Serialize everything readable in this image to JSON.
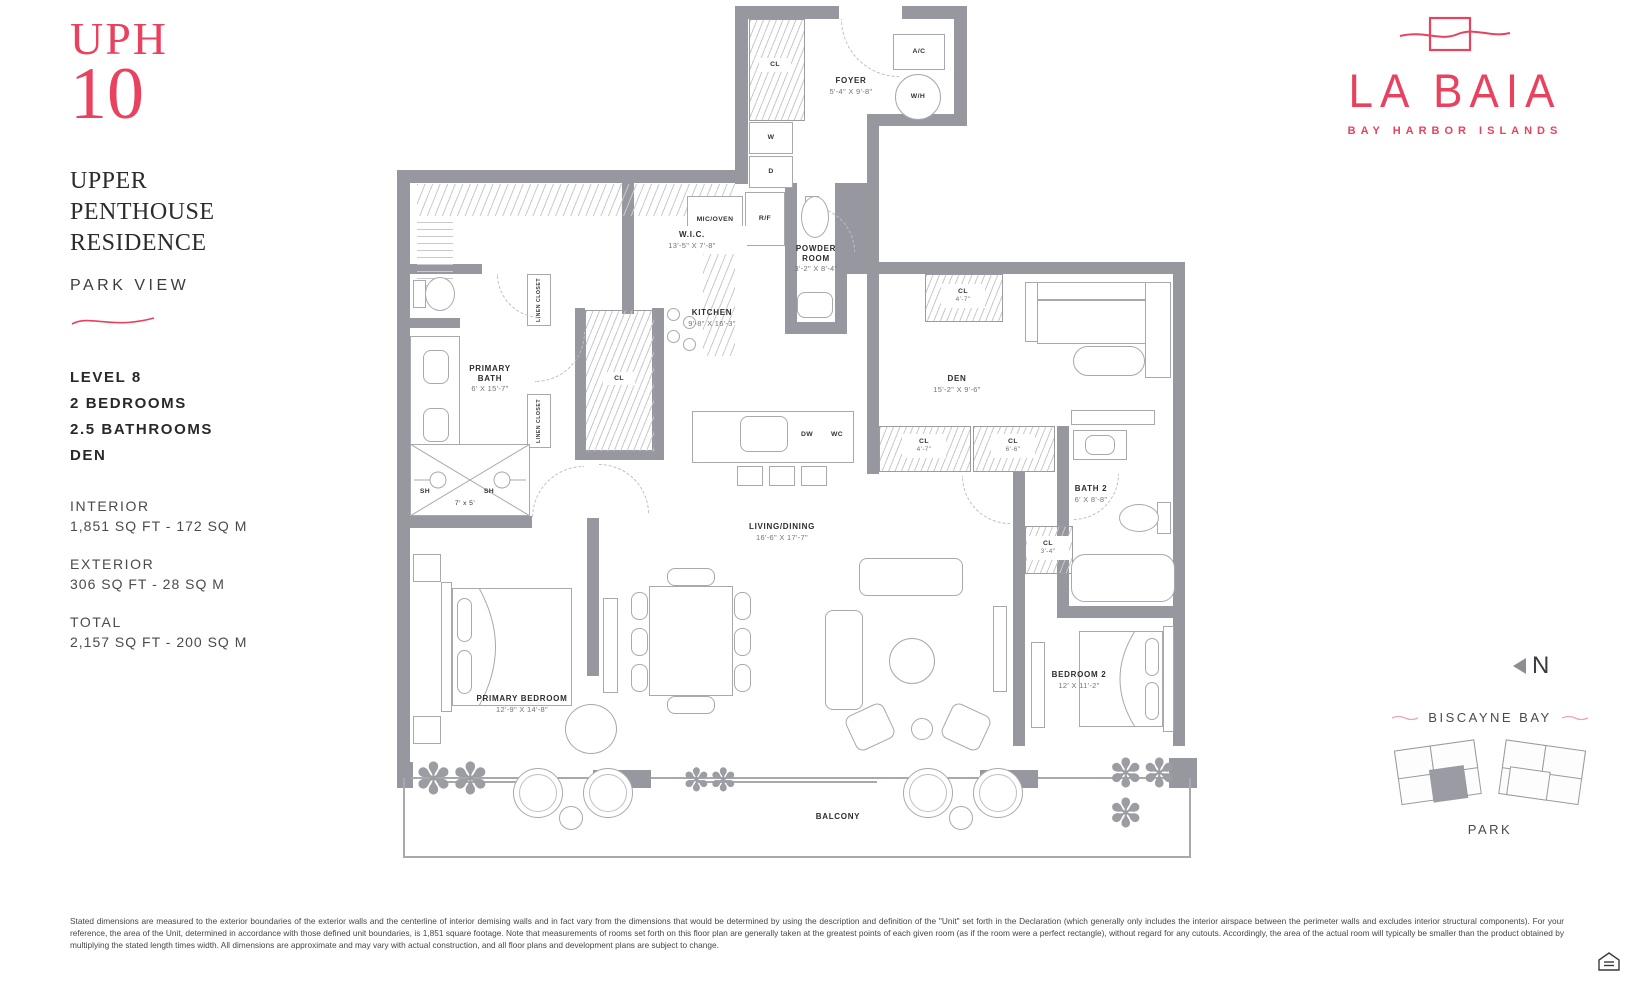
{
  "sidebar": {
    "unit_prefix": "UPH",
    "unit_number": "10",
    "residence_title": "UPPER PENTHOUSE RESIDENCE",
    "view": "PARK VIEW",
    "level": "LEVEL 8",
    "bedrooms": "2 BEDROOMS",
    "bathrooms": "2.5 BATHROOMS",
    "den": "DEN",
    "interior_label": "INTERIOR",
    "interior_value": "1,851 SQ FT - 172 SQ M",
    "exterior_label": "EXTERIOR",
    "exterior_value": "306 SQ FT - 28 SQ M",
    "total_label": "TOTAL",
    "total_value": "2,157 SQ FT - 200 SQ M"
  },
  "brand": {
    "name": "LA BAIA",
    "tagline": "BAY HARBOR ISLANDS"
  },
  "compass": {
    "n": "N"
  },
  "keyplan": {
    "bay": "BISCAYNE BAY",
    "park": "PARK"
  },
  "plan": {
    "rooms": {
      "foyer": {
        "name": "FOYER",
        "dims": "5'-4\" x 9'-8\""
      },
      "wic": {
        "name": "W.I.C.",
        "dims": "13'-5\" x 7'-8\""
      },
      "powder": {
        "name": "POWDER ROOM",
        "dims": "3'-2\" x 8'-4\""
      },
      "kitchen": {
        "name": "KITCHEN",
        "dims": "9'-8\" x 16'-3\""
      },
      "primary_bath": {
        "name": "PRIMARY BATH",
        "dims": "6' x 15'-7\""
      },
      "den": {
        "name": "DEN",
        "dims": "15'-2\" x 9'-6\""
      },
      "living_dining": {
        "name": "LIVING/DINING",
        "dims": "16'-6\" x 17'-7\""
      },
      "bath2": {
        "name": "BATH 2",
        "dims": "6' x 8'-8\""
      },
      "primary_bedroom": {
        "name": "PRIMARY BEDROOM",
        "dims": "12'-9\" x 14'-8\""
      },
      "bedroom2": {
        "name": "BEDROOM 2",
        "dims": "12' x 11'-2\""
      },
      "balcony": {
        "name": "BALCONY"
      },
      "shower_dims": "7' x 5'"
    },
    "labels": {
      "cl": "CL",
      "w": "W",
      "d": "D",
      "ac": "A/C",
      "wh": "W/H",
      "mic_oven": "MIC/OVEN",
      "rf": "R/F",
      "linen_closet": "LINEN CLOSET",
      "sh": "SH",
      "dw": "DW",
      "wc": "WC",
      "cl_4_7": "4'-7\"",
      "cl_6_6": "6'-6\"",
      "cl_3_4": "3'-4\""
    }
  },
  "footer": {
    "disclaimer": "Stated dimensions are measured to the exterior boundaries of the exterior walls and the centerline of interior demising walls and in fact vary from the dimensions that would be determined by using the description and definition of the \"Unit\" set forth in the Declaration (which generally only includes the interior airspace between the perimeter walls and excludes interior structural components).  For your reference, the area of the Unit, determined in accordance with those defined unit boundaries, is 1,851 square footage. Note that measurements of rooms set forth on this floor plan are generally taken at the greatest points of each given room (as if the room were a perfect rectangle), without regard for any cutouts. Accordingly, the area of the actual room will typically be smaller than the product obtained by multiplying the stated length times width. All dimensions are approximate and may vary with actual construction, and all floor plans and development plans are subject to change."
  },
  "colors": {
    "accent_pink": "#e8425f",
    "wall_gray": "#97989f",
    "text_dark": "#2e2e33"
  }
}
